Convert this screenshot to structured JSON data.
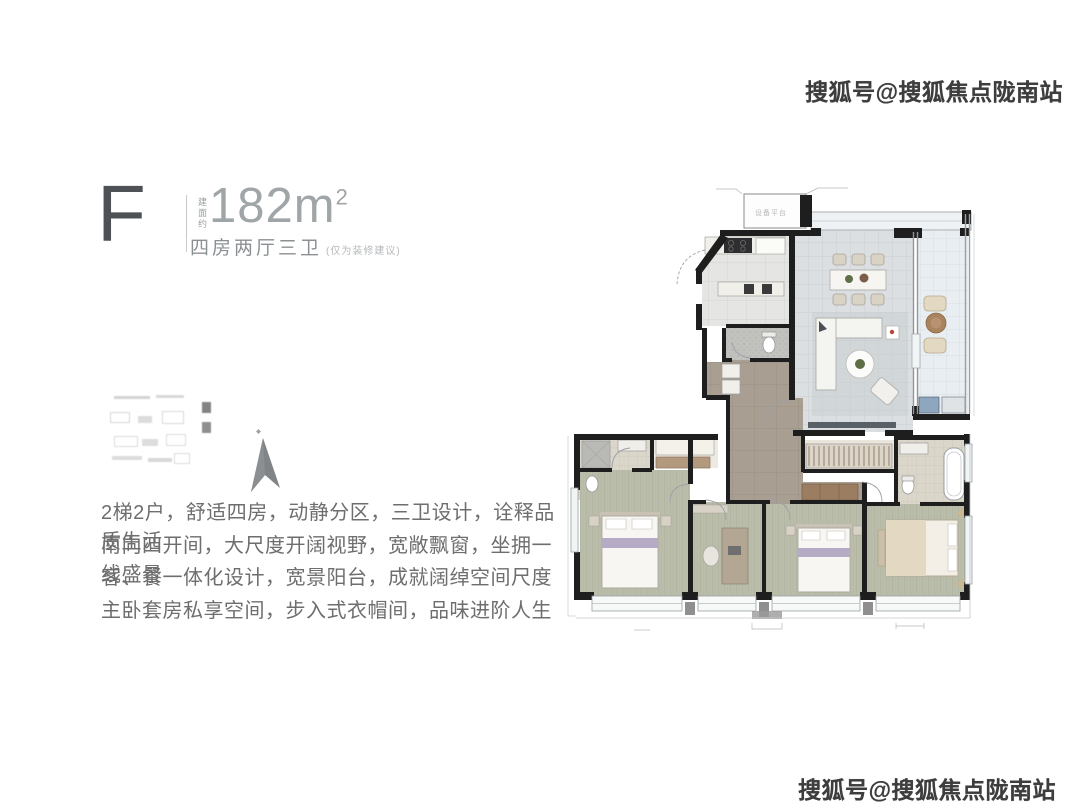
{
  "header": {
    "unit_letter": "F",
    "area_prefix": "建面约",
    "area_value": "182",
    "area_unit": "m",
    "area_sup": "2",
    "layout": "四房两厅三卫",
    "layout_note": "(仅为装修建议)"
  },
  "description": {
    "lines": [
      "2梯2户，舒适四房，动静分区，三卫设计，诠释品质生活",
      "南向四开间，大尺度开阔视野，宽敞飘窗，坐拥一线盛景",
      "客、餐一体化设计，宽景阳台，成就阔绰空间尺度",
      "主卧套房私享空间，步入式衣帽间，品味进阶人生"
    ]
  },
  "watermark": {
    "text": "搜狐号@搜狐焦点陇南站",
    "color": "#3d3d3d"
  },
  "floor_plan": {
    "equipment_label": "设备平台",
    "colors": {
      "wall": "#1e1e1e",
      "living_tile": "#dcdfe1",
      "balcony_tile": "#e9eef2",
      "kitchen_tile": "#e5e6e3",
      "hall_taupe": "#a89e92",
      "bedroom_wood": "#babdaa",
      "bath_tile": "#dad6ca",
      "window_frame": "#8f969c",
      "bed_accent_lilac": "#b6abc4",
      "furniture_brown": "#9b7e62",
      "furniture_beige": "#e3d9c2"
    }
  }
}
